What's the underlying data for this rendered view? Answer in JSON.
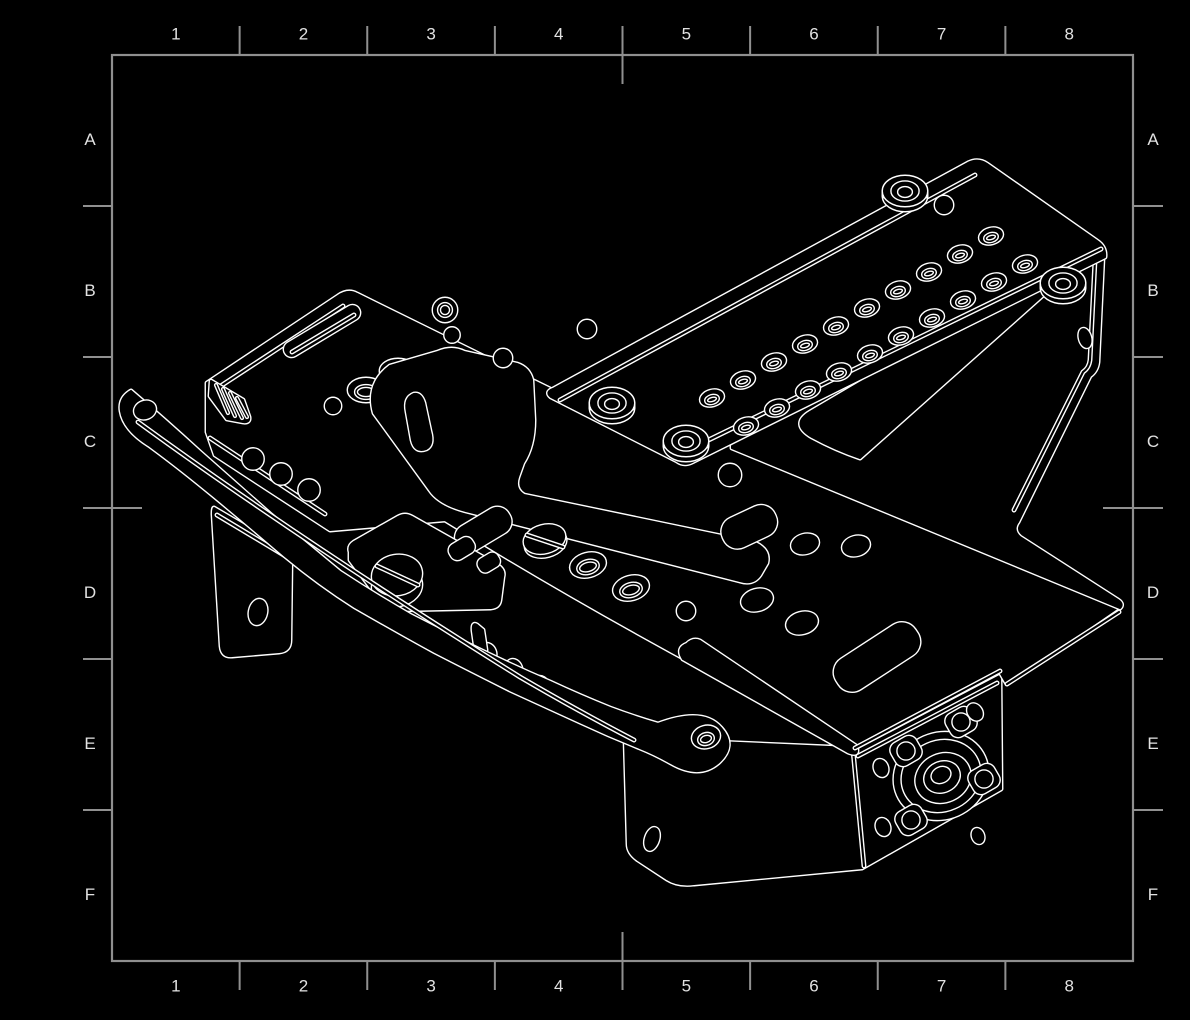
{
  "canvas": {
    "width": 1190,
    "height": 1020,
    "background_color": "#000000"
  },
  "frame": {
    "border_color": "#8f8f8f",
    "tick_color": "#909090",
    "label_color": "#e2e2e2",
    "left": 112,
    "top": 55,
    "right": 1133,
    "bottom": 961
  },
  "grid": {
    "columns": [
      "1",
      "2",
      "3",
      "4",
      "5",
      "6",
      "7",
      "8"
    ],
    "rows": [
      "A",
      "B",
      "C",
      "D",
      "E",
      "F"
    ]
  },
  "drawing": {
    "description": "Isometric wireframe CAD line drawing of a chassis frame assembly",
    "line_color": "#ffffff",
    "face_color": "#000000",
    "features": [
      "perforated-deck-plate",
      "corner-bosses",
      "right-support-wall",
      "triangular-cutout",
      "main-chassis-plate",
      "central-cutout",
      "elongated-slot",
      "curved-front-arm",
      "hanging-bracket",
      "screw-head-boss",
      "bottom-panel",
      "bearing-hub",
      "bolt-tabs"
    ]
  }
}
